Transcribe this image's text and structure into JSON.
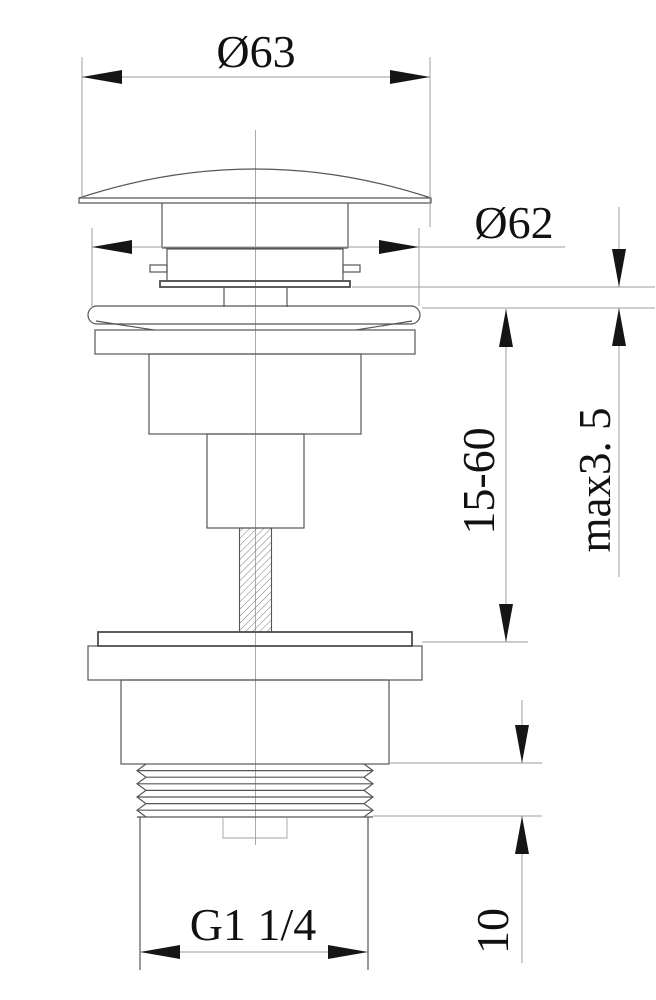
{
  "colors": {
    "background": "#ffffff",
    "outline": "#565656",
    "dimension_line": "#9c9c9c",
    "ink": "#111111"
  },
  "dims": {
    "cap_diameter": "Ø63",
    "flange_diameter": "Ø62",
    "adjust_range": "15-60",
    "max_thickness": "max3. 5",
    "thread_length": "10",
    "thread_size": "G1 1/4"
  }
}
